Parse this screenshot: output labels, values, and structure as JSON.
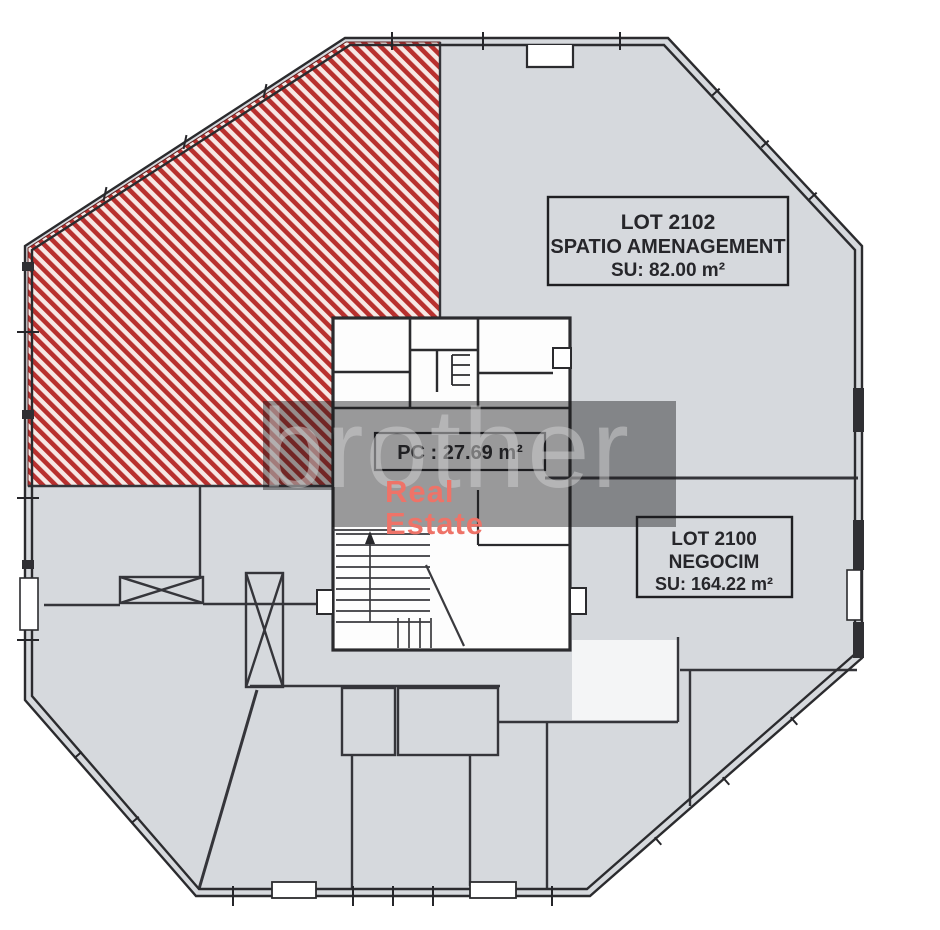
{
  "plan": {
    "lots": [
      {
        "id": "LOT 2102",
        "name": "SPATIO AMENAGEMENT",
        "area_label": "SU: 82.00 m²"
      },
      {
        "id": "LOT 2100",
        "name": "NEGOCIM",
        "area_label": "SU: 164.22 m²"
      }
    ],
    "core_label": "PC : 27.69 m²"
  },
  "watermark": {
    "text": "brother",
    "brand_line1": "Real",
    "brand_line2": "Estate"
  },
  "colors": {
    "floor_gray": "#d6d9dd",
    "hatch_red": "#b8302e",
    "hatch_bg": "#f7e8e5",
    "wall_dark": "#2b2b2e",
    "brand_red": "#ee7368",
    "overlay": "rgba(25,25,28,0.44)"
  }
}
